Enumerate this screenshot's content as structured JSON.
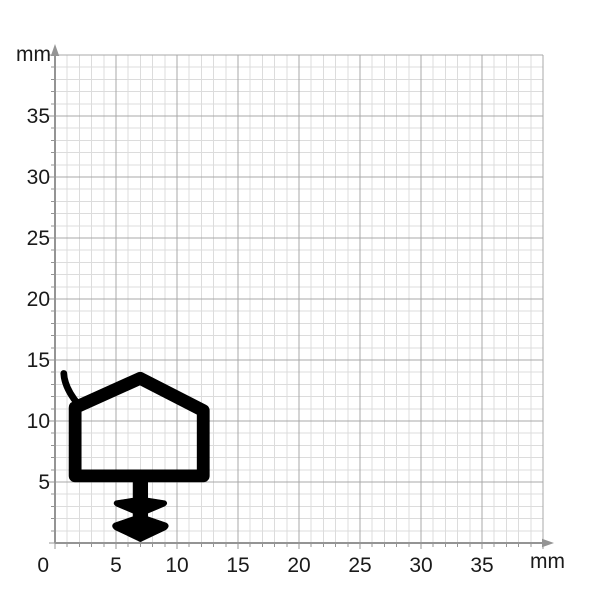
{
  "figure": {
    "type": "technical-profile-diagram",
    "description": "Black sealing-profile cross-section drawn on millimeter graph paper",
    "x_unit_label": "mm",
    "y_unit_label": "mm",
    "axes": {
      "x_ticks": [
        0,
        5,
        10,
        15,
        20,
        25,
        30,
        35
      ],
      "y_ticks": [
        5,
        10,
        15,
        20,
        25,
        30,
        35
      ],
      "x_range_mm": [
        0,
        40
      ],
      "y_range_mm": [
        0,
        40
      ],
      "minor_step_mm": 1,
      "major_step_mm": 5
    },
    "colors": {
      "background": "#ffffff",
      "grid_minor": "#dcdcdc",
      "grid_major": "#a9a9a9",
      "axis": "#949494",
      "label": "#1a1a1a",
      "profile": "#000000"
    },
    "profile": {
      "name": "sealing-profile-cross-section",
      "chamber_centerline_mm": [
        [
          1.65,
          5.5
        ],
        [
          1.65,
          11.1
        ],
        [
          6.98,
          13.5
        ],
        [
          12.15,
          10.85
        ],
        [
          12.15,
          5.5
        ]
      ],
      "chamber_wall_thickness_mm": 1.05,
      "lip_mm": {
        "from": [
          0.72,
          13.9
        ],
        "control": [
          0.78,
          12.7
        ],
        "to": [
          1.95,
          11.3
        ],
        "thickness_mm": 0.55
      },
      "anchor_path_mm": "M 6.4 5.8 L 6.4 3.68 L 4.98 3.46 Q 4.68 3.26 5.02 3.02 L 6.4 2.44 L 6.4 2.16 L 4.88 1.64 Q 4.52 1.4 4.94 1.08 L 6.8 0.2 Q 7.0 0.02 7.2 0.2 L 9.06 1.08 Q 9.48 1.4 9.12 1.64 L 7.6 2.16 L 7.6 2.44 L 8.98 3.02 Q 9.32 3.26 9.02 3.46 L 7.6 3.68 L 7.6 5.8 Z"
    }
  }
}
